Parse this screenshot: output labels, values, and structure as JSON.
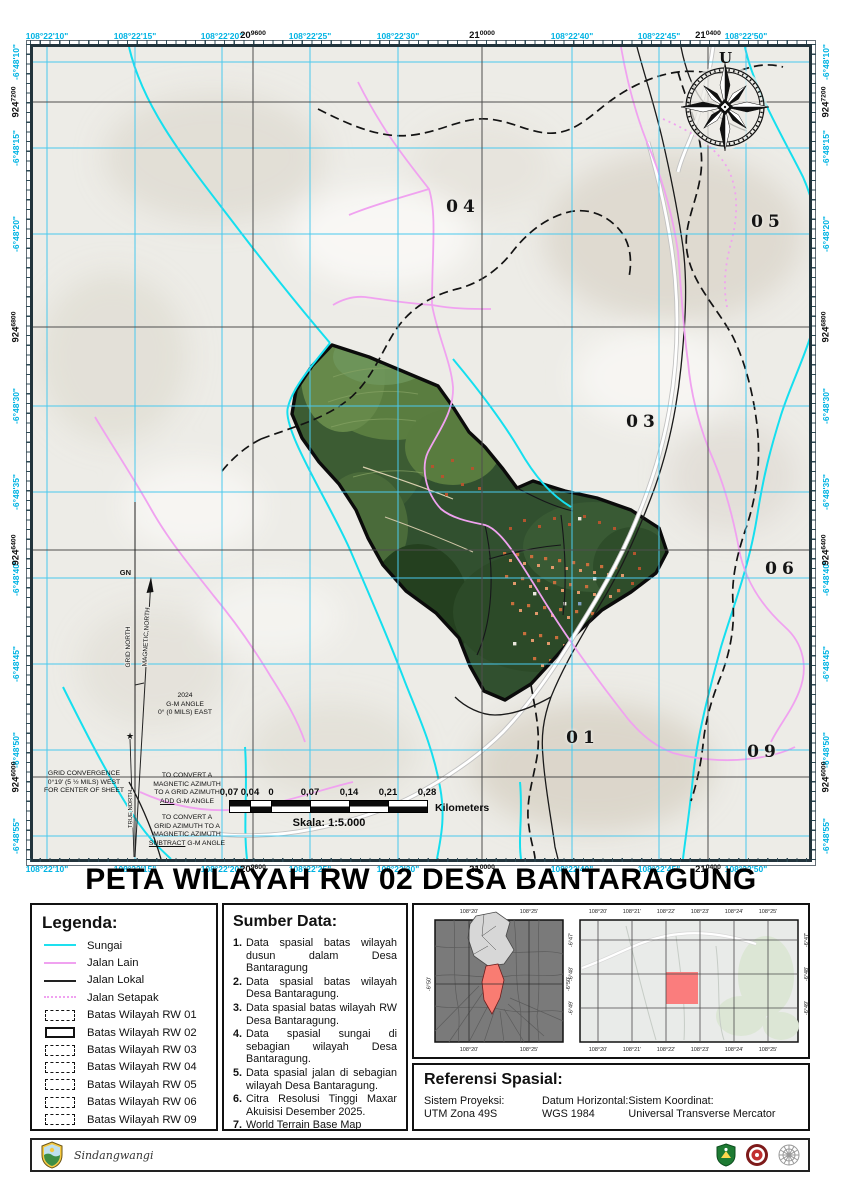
{
  "page_title": "PETA WILAYAH RW 02 DESA BANTARAGUNG",
  "map": {
    "north_label": "U",
    "axis": {
      "top_geo": [
        {
          "t": "108°22'10\"",
          "x": 14
        },
        {
          "t": "108°22'15\"",
          "x": 102
        },
        {
          "t": "108°22'20\"",
          "x": 189
        },
        {
          "t": "108°22'25\"",
          "x": 277
        },
        {
          "t": "108°22'30\"",
          "x": 365
        },
        {
          "t": "108°22'40\"",
          "x": 539
        },
        {
          "t": "108°22'45\"",
          "x": 626
        },
        {
          "t": "108°22'50\"",
          "x": 713
        }
      ],
      "top_grid": [
        {
          "big": "20",
          "sup": "9600",
          "x": 220
        },
        {
          "big": "21",
          "sup": "0000",
          "x": 449
        },
        {
          "big": "21",
          "sup": "0400",
          "x": 675
        }
      ],
      "left_geo": [
        {
          "t": "-6°48'10\"",
          "y": 15
        },
        {
          "t": "-6°48'15\"",
          "y": 101
        },
        {
          "t": "-6°48'20\"",
          "y": 187
        },
        {
          "t": "-6°48'30\"",
          "y": 359
        },
        {
          "t": "-6°48'35\"",
          "y": 445
        },
        {
          "t": "-6°48'40\"",
          "y": 531
        },
        {
          "t": "-6°48'45\"",
          "y": 617
        },
        {
          "t": "-6°48'50\"",
          "y": 703
        },
        {
          "t": "-6°48'55\"",
          "y": 789
        }
      ],
      "left_grid": [
        {
          "big": "924",
          "sup": "7200",
          "y": 55
        },
        {
          "big": "924",
          "sup": "6800",
          "y": 280
        },
        {
          "big": "924",
          "sup": "6400",
          "y": 503
        },
        {
          "big": "924",
          "sup": "6000",
          "y": 730
        }
      ]
    },
    "region_labels": [
      {
        "t": "04",
        "x": 430,
        "y": 160
      },
      {
        "t": "05",
        "x": 735,
        "y": 175
      },
      {
        "t": "03",
        "x": 610,
        "y": 375
      },
      {
        "t": "06",
        "x": 749,
        "y": 522
      },
      {
        "t": "01",
        "x": 550,
        "y": 691
      },
      {
        "t": "09",
        "x": 731,
        "y": 705
      }
    ],
    "declination": {
      "gn": "GN",
      "grid_north": "GRID NORTH",
      "magnetic_north": "MAGNETIC NORTH",
      "true_north": "TRUE NORTH",
      "gm_angle_lines": [
        {
          "t": "2024"
        },
        {
          "t": "G-M ANGLE"
        },
        {
          "t": "0° (0 MILS)  EAST"
        }
      ],
      "convergence_lines": [
        {
          "t": "GRID CONVERGENCE"
        },
        {
          "t": "0°19' (5 ½ MILS)  WEST"
        },
        {
          "t": "FOR CENTER OF SHEET"
        }
      ],
      "convert_magnetic_lines": [
        {
          "t": "TO CONVERT A"
        },
        {
          "t": "MAGNETIC AZIMUTH"
        },
        {
          "t": "TO A GRID AZIMUTH"
        }
      ],
      "convert_magnetic_em": "ADD",
      "convert_magnetic_tail": " G-M ANGLE",
      "convert_grid_lines": [
        {
          "t": "TO CONVERT A"
        },
        {
          "t": "GRID AZIMUTH TO A"
        },
        {
          "t": "MAGNETIC AZIMUTH"
        }
      ],
      "convert_grid_em": "SUBTRACT",
      "convert_grid_tail": " G-M ANGLE"
    },
    "scalebar": {
      "ticks": [
        {
          "t": "0,07",
          "x": 0
        },
        {
          "t": "0,04",
          "x": 21
        },
        {
          "t": "0",
          "x": 42
        },
        {
          "t": "0,07",
          "x": 81
        },
        {
          "t": "0,14",
          "x": 120
        },
        {
          "t": "0,21",
          "x": 159
        },
        {
          "t": "0,28",
          "x": 198
        }
      ],
      "unit": "Kilometers",
      "scale_text": "Skala: 1:5.000"
    }
  },
  "legend": {
    "title": "Legenda:",
    "items": [
      {
        "label": "Sungai",
        "type": "line-cyan"
      },
      {
        "label": "Jalan Lain",
        "type": "line-pink"
      },
      {
        "label": "Jalan Lokal",
        "type": "line-black"
      },
      {
        "label": "Jalan Setapak",
        "type": "dots-pink"
      },
      {
        "label": "Batas Wilayah RW 01",
        "type": "rect-dashed"
      },
      {
        "label": "Batas Wilayah RW 02",
        "type": "rect-solid"
      },
      {
        "label": "Batas Wilayah RW 03",
        "type": "rect-dashed"
      },
      {
        "label": "Batas Wilayah RW 04",
        "type": "rect-dashed"
      },
      {
        "label": "Batas Wilayah RW 05",
        "type": "rect-dashed"
      },
      {
        "label": "Batas Wilayah RW 06",
        "type": "rect-dashed"
      },
      {
        "label": "Batas Wilayah RW 09",
        "type": "rect-dashed"
      }
    ]
  },
  "sumber": {
    "title": "Sumber Data:",
    "items": [
      {
        "n": "1.",
        "text": "Data spasial batas wilayah dusun dalam Desa Bantaragung"
      },
      {
        "n": "2.",
        "text": "Data spasial batas wilayah Desa Bantaragung."
      },
      {
        "n": "3.",
        "text": "Data spasial batas wilayah RW Desa Bantaragung."
      },
      {
        "n": "4.",
        "text": "Data spasial sungai di sebagian wilayah Desa Bantaragung."
      },
      {
        "n": "5.",
        "text": "Data spasial jalan di sebagian wilayah Desa Bantaragung."
      },
      {
        "n": "6.",
        "text": "Citra Resolusi Tinggi Maxar Akuisisi Desember 2025."
      },
      {
        "n": "7.",
        "text": "World Terrain Base Map"
      }
    ]
  },
  "referensi": {
    "title": "Referensi Spasial:",
    "fields": [
      {
        "label": "Sistem Proyeksi:",
        "value": "UTM Zona 49S"
      },
      {
        "label": "Datum Horizontal:",
        "value": "WGS 1984"
      },
      {
        "label": "Sistem Koordinat:",
        "value": "Universal Transverse Mercator"
      }
    ]
  },
  "insets": {
    "left": {
      "top": [
        {
          "t": "108°20'",
          "x": 45
        },
        {
          "t": "108°25'",
          "x": 105
        }
      ],
      "west": [
        {
          "t": "-6°50'",
          "y": 78
        }
      ],
      "east": [
        {
          "t": "-6°50'",
          "y": 78
        }
      ]
    },
    "right": {
      "top": [
        {
          "t": "108°20'",
          "x": 32
        },
        {
          "t": "108°21'",
          "x": 66
        },
        {
          "t": "108°22'",
          "x": 100
        },
        {
          "t": "108°23'",
          "x": 134
        },
        {
          "t": "108°24'",
          "x": 168
        },
        {
          "t": "108°25'",
          "x": 202
        }
      ],
      "west": [
        {
          "t": "-6°47'",
          "y": 34
        },
        {
          "t": "-6°48'",
          "y": 68
        },
        {
          "t": "-6°49'",
          "y": 102
        }
      ]
    }
  },
  "footer": {
    "script_text": "Sindangwangi"
  },
  "colors": {
    "river": "#15dfef",
    "road_other": "#f0a2f0",
    "road_lokal": "#1a1a1a",
    "boundary": "#111111",
    "geo_label": "#00b3e3",
    "grid_label": "#111111",
    "rw_highlight": "#fa7d7d",
    "graticule": "#49c9ee",
    "utm_grid": "#4e4e4e"
  }
}
